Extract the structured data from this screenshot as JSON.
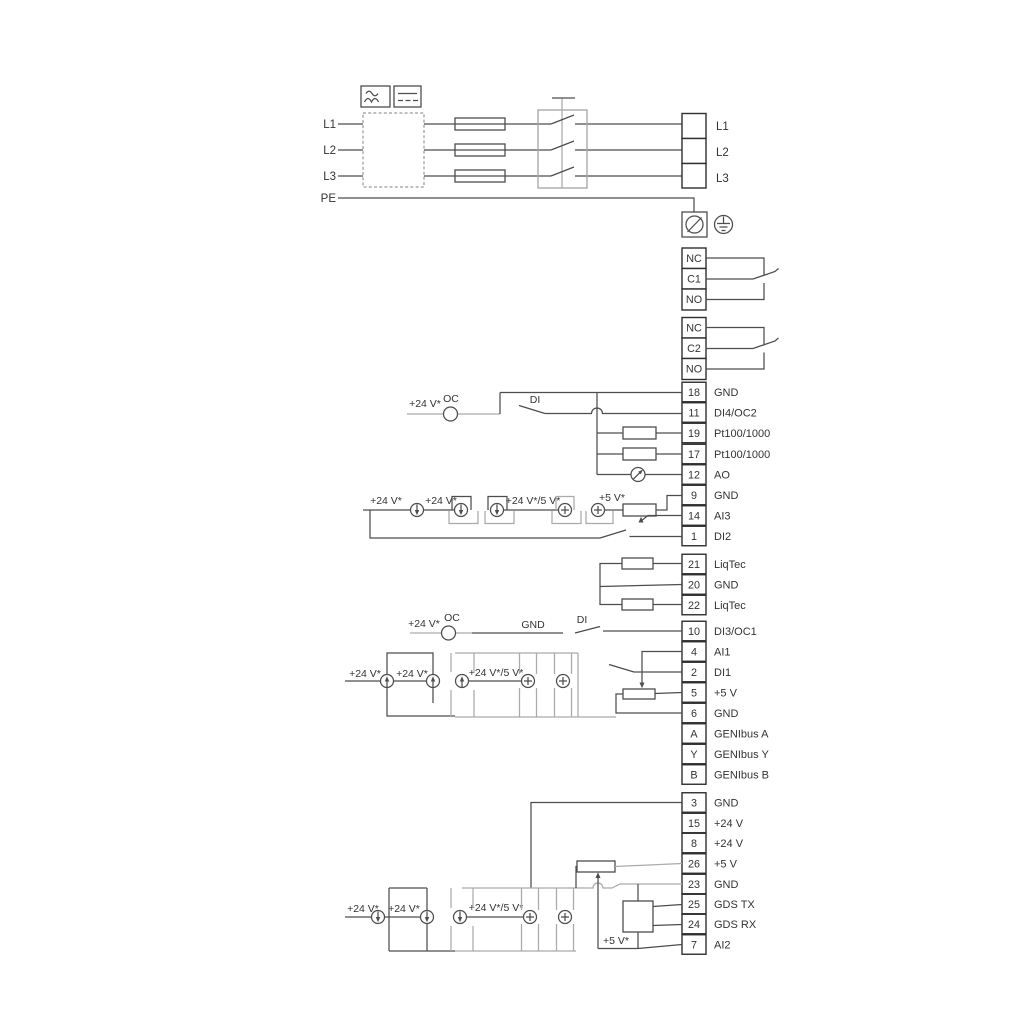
{
  "colors": {
    "line": "#4d4d4d",
    "gray": "#aaaaaa",
    "text": "#333333",
    "background": "#ffffff"
  },
  "power": {
    "inputs": [
      "L1",
      "L2",
      "L3",
      "PE"
    ],
    "outputs": [
      "L1",
      "L2",
      "L3"
    ],
    "symbols": {
      "ac": "ac-waveform-icon",
      "dc": "dc-lines-icon",
      "filter": "dashed-filter-box",
      "fuse": "fuse",
      "switch": "main-switch",
      "pe_screw": "pe-screw-terminal-icon",
      "earth": "earth-ground-icon"
    }
  },
  "relay1": {
    "terminals": [
      "NC",
      "C1",
      "NO"
    ]
  },
  "relay2": {
    "terminals": [
      "NC",
      "C2",
      "NO"
    ]
  },
  "labels": {
    "v24": "+24 V*",
    "v24_5": "+24 V*/5 V*",
    "v5": "+5 V*",
    "oc": "OC",
    "di": "DI",
    "gnd": "GND"
  },
  "io_group1": [
    {
      "num": "18",
      "label": "GND"
    },
    {
      "num": "11",
      "label": "DI4/OC2"
    },
    {
      "num": "19",
      "label": "Pt100/1000"
    },
    {
      "num": "17",
      "label": "Pt100/1000"
    },
    {
      "num": "12",
      "label": "AO"
    },
    {
      "num": "9",
      "label": "GND"
    },
    {
      "num": "14",
      "label": "AI3"
    },
    {
      "num": "1",
      "label": "DI2"
    }
  ],
  "liqtec_group": [
    {
      "num": "21",
      "label": "LiqTec"
    },
    {
      "num": "20",
      "label": "GND"
    },
    {
      "num": "22",
      "label": "LiqTec"
    }
  ],
  "io_group2": [
    {
      "num": "10",
      "label": "DI3/OC1"
    },
    {
      "num": "4",
      "label": "AI1"
    },
    {
      "num": "2",
      "label": "DI1"
    },
    {
      "num": "5",
      "label": "+5 V"
    },
    {
      "num": "6",
      "label": "GND"
    },
    {
      "num": "A",
      "label": "GENIbus A"
    },
    {
      "num": "Y",
      "label": "GENIbus Y"
    },
    {
      "num": "B",
      "label": "GENIbus B"
    }
  ],
  "io_group3": [
    {
      "num": "3",
      "label": "GND"
    },
    {
      "num": "15",
      "label": "+24 V"
    },
    {
      "num": "8",
      "label": "+24 V"
    },
    {
      "num": "26",
      "label": "+5 V"
    },
    {
      "num": "23",
      "label": "GND"
    },
    {
      "num": "25",
      "label": "GDS TX"
    },
    {
      "num": "24",
      "label": "GDS RX"
    },
    {
      "num": "7",
      "label": "AI2"
    }
  ]
}
